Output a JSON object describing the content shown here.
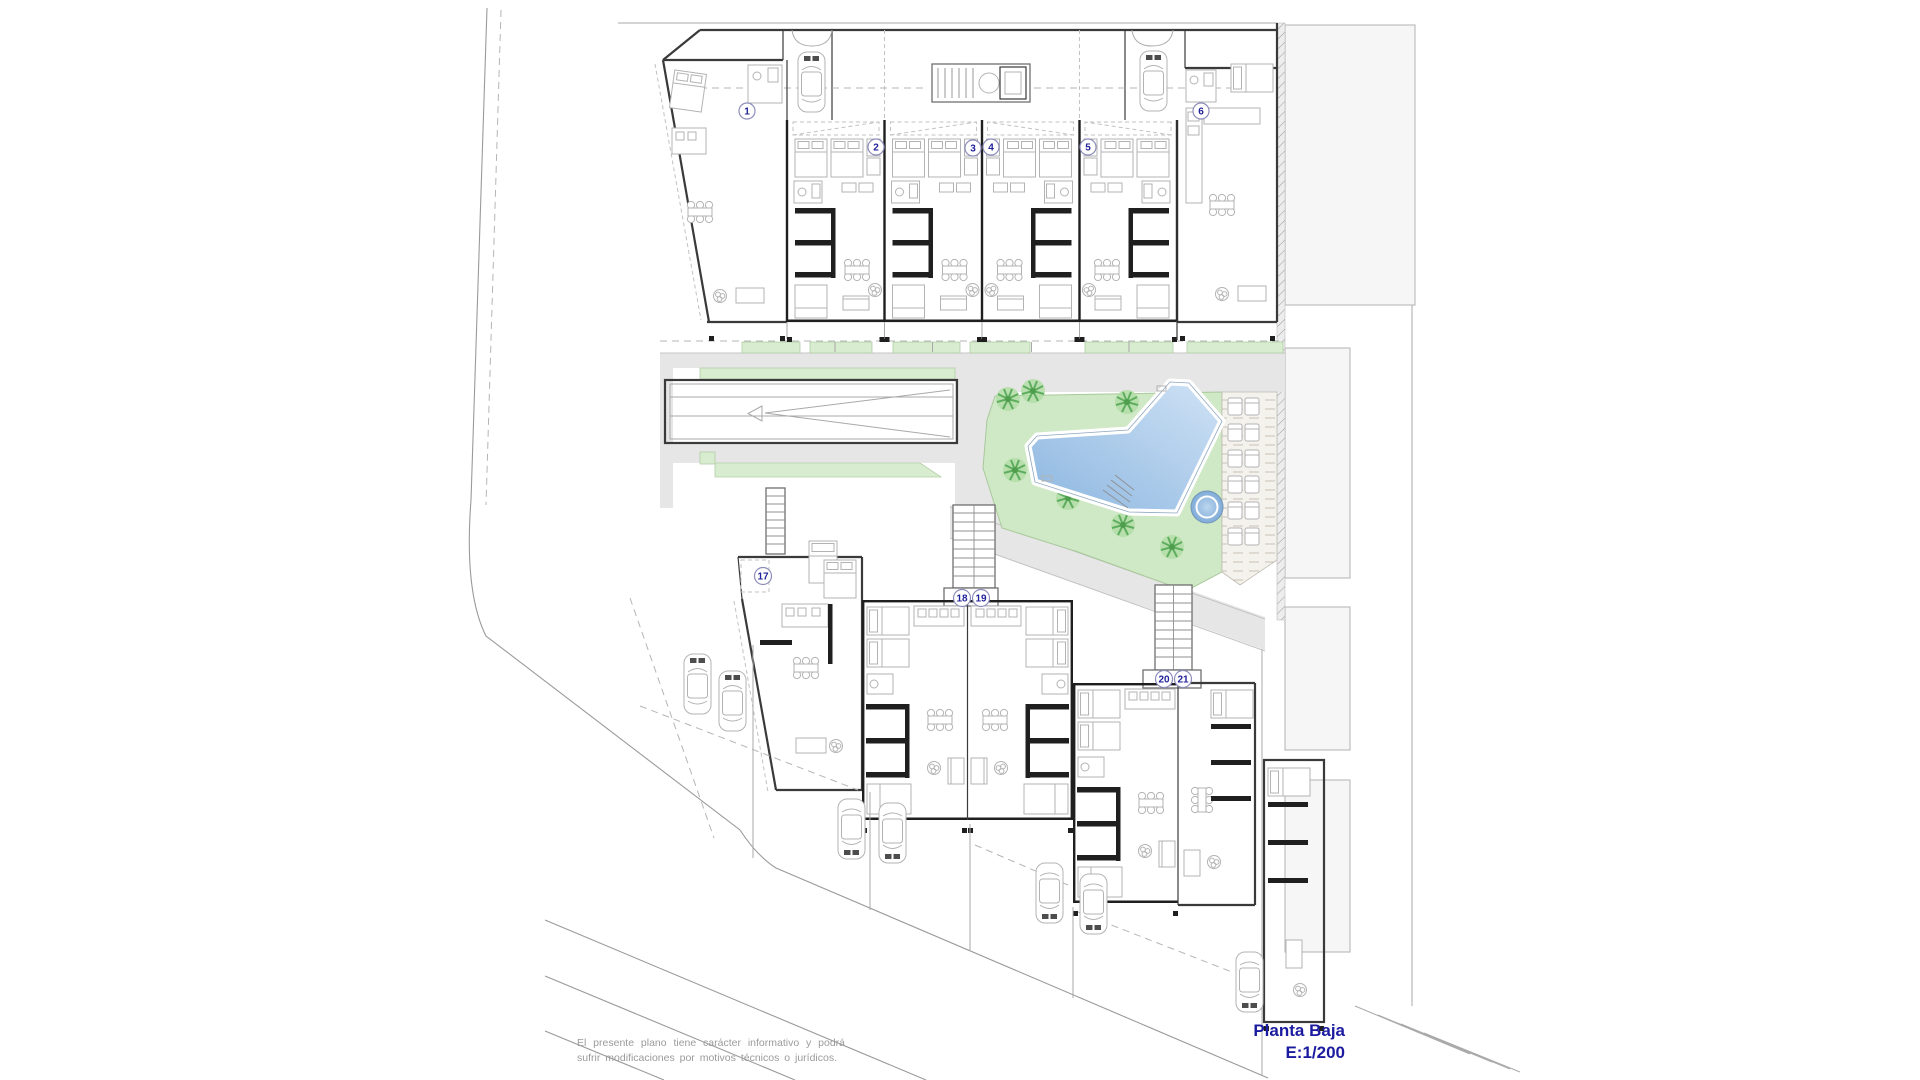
{
  "document": {
    "type": "architectural-floor-plan"
  },
  "title": {
    "floor": "Planta Baja",
    "scale": "E:1/200"
  },
  "disclaimer": {
    "line1": "El presente plano tiene carácter informativo y podrá sufrir",
    "line2": "modificaciones por motivos técnicos o jurídicos."
  },
  "plan": {
    "unit_numbers": [
      "1",
      "2",
      "3",
      "4",
      "5",
      "6",
      "17",
      "18",
      "19",
      "20",
      "21"
    ],
    "features": [
      "swimming-pool",
      "spa",
      "lawn",
      "palm-trees",
      "sun-loungers",
      "garage-ramp",
      "stairs",
      "parking",
      "cars"
    ],
    "colors": {
      "pool_light": "#cfe2f5",
      "pool_dark": "#8cb6e0",
      "spa": "#7fabd8",
      "lawn": "#cfe8c5",
      "landscape_strip": "#d8ecd0",
      "path_gray": "#e6e6e6",
      "wall": "#3a3a3a",
      "label_navy": "#22229a",
      "title_navy": "#1b1ba0",
      "disclaimer_gray": "#9b9b9b"
    }
  }
}
